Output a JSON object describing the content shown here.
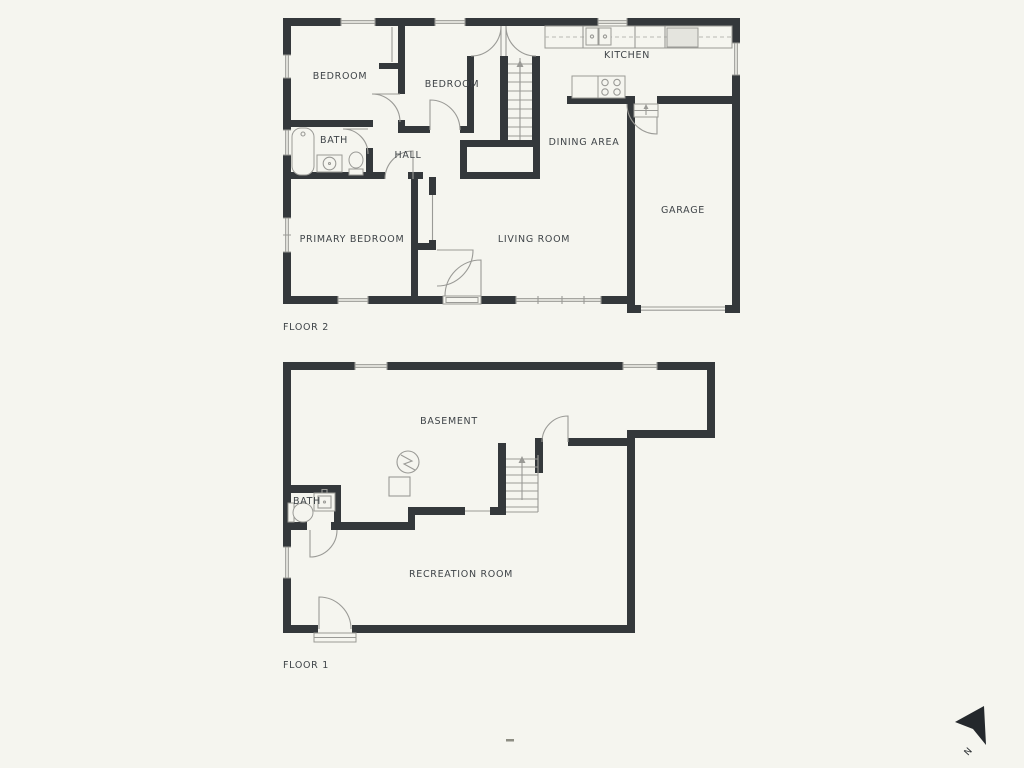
{
  "document": {
    "type": "floor-plan",
    "floors_count": 2
  },
  "colors": {
    "bg": "#f5f5ef",
    "wall": "#34383b",
    "line": "#9a9a96",
    "text": "#3f4448",
    "appliance": "#e4e4de",
    "compass": "#24282c"
  },
  "floor2": {
    "name": "FLOOR 2",
    "bedroom_left": "BEDROOM",
    "bedroom_mid": "BEDROOM",
    "kitchen": "KITCHEN",
    "bath": "BATH",
    "hall": "HALL",
    "dining": "DINING AREA",
    "primary_bedroom": "PRIMARY BEDROOM",
    "living": "LIVING ROOM",
    "garage": "GARAGE"
  },
  "floor1": {
    "name": "FLOOR 1",
    "basement": "BASEMENT",
    "bath": "BATH",
    "recreation": "RECREATION ROOM"
  },
  "compass": {
    "north": "N"
  }
}
